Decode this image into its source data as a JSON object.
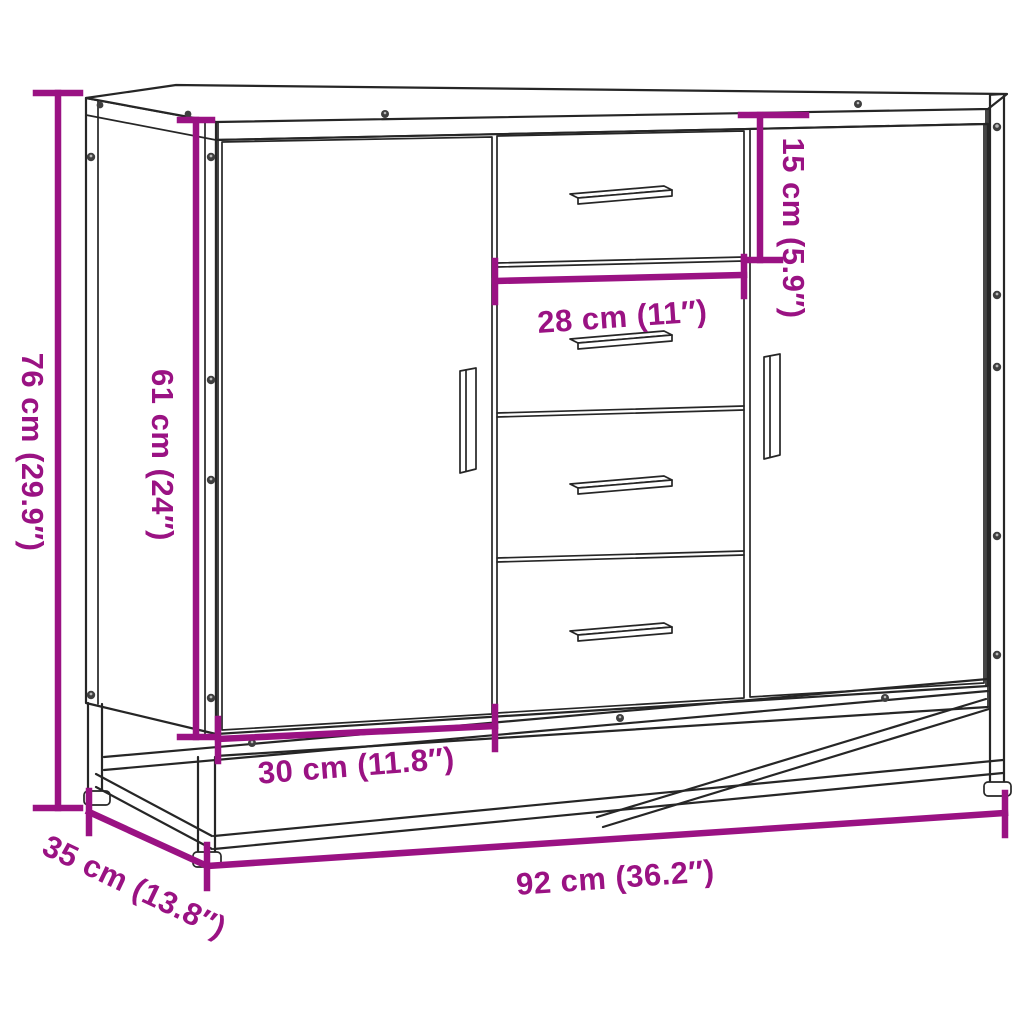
{
  "diagram": {
    "kind": "furniture-dimension-diagram",
    "colors": {
      "dimension_accent": "#9A1283",
      "line_art": "#262626",
      "background": "#ffffff"
    },
    "dimensions": {
      "overall_height": {
        "cm": "76",
        "inch": "29.9",
        "label": "76 cm (29.9″)"
      },
      "cabinet_height": {
        "cm": "61",
        "inch": "24",
        "label": "61 cm (24″)"
      },
      "top_drawer_height": {
        "cm": "15",
        "inch": "5.9",
        "label": "15 cm (5.9″)"
      },
      "drawer_width": {
        "cm": "28",
        "inch": "11",
        "label": "28 cm (11″)"
      },
      "door_width": {
        "cm": "30",
        "inch": "11.8",
        "label": "30 cm (11.8″)"
      },
      "overall_width": {
        "cm": "92",
        "inch": "36.2",
        "label": "92 cm (36.2″)"
      },
      "overall_depth": {
        "cm": "35",
        "inch": "13.8",
        "label": "35 cm (13.8″)"
      }
    }
  }
}
